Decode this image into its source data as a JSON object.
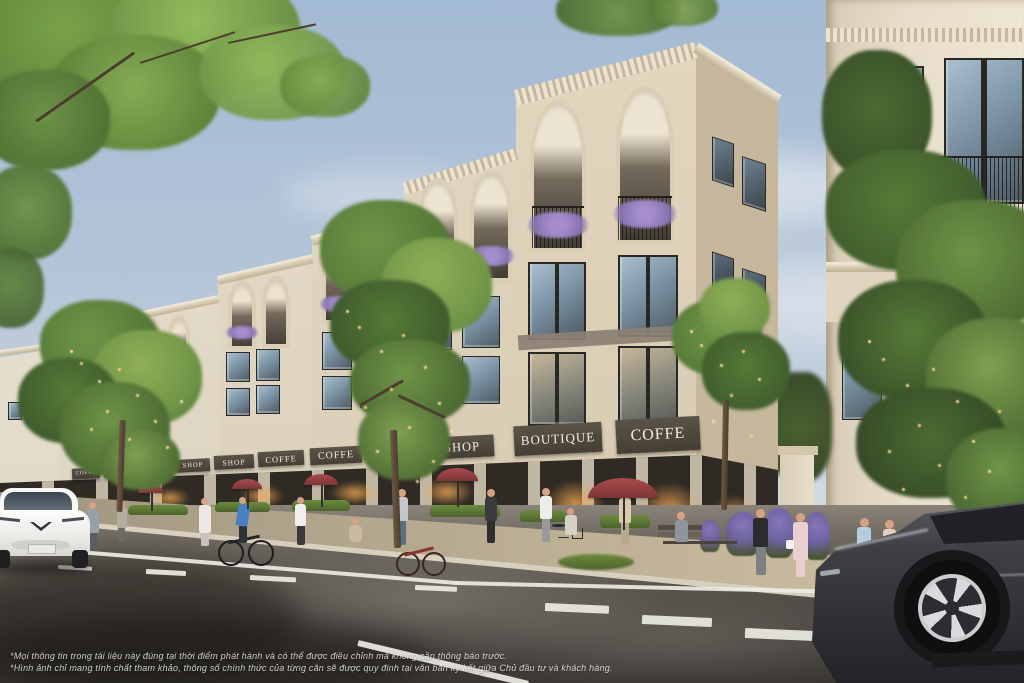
{
  "facade": {
    "signs": [
      {
        "label": "COFFE"
      },
      {
        "label": "BOUTIQUE"
      },
      {
        "label": "COFFE"
      },
      {
        "label": "SHOP"
      },
      {
        "label": "SHOP"
      },
      {
        "label": "COFFE"
      },
      {
        "label": "COFFE"
      },
      {
        "label": "SHOP"
      },
      {
        "label": "SHOP"
      },
      {
        "label": "BOUTIQUE"
      },
      {
        "label": "COFFE"
      }
    ]
  },
  "disclaimer": {
    "line1": "*Mọi thông tin trong tài liệu này đúng tại thời điểm phát hành và có thể được điều chỉnh mà không cần thông báo trước.",
    "line2": "*Hình ảnh chỉ mang tính chất tham khảo, thông số chính thức của từng căn sẽ được quy định tại văn bản ký kết giữa Chủ đầu tư và khách hàng."
  },
  "palette": {
    "sky_top": "#a3bad4",
    "sky_bottom": "#e3e7ea",
    "facade_cream": "#e2d7c1",
    "awning": "#453e34",
    "sign_text": "#f3eee3",
    "umbrella_red": "#a84c4c",
    "wisteria_purple": "#ab92d4",
    "foliage_green": "#567a37",
    "string_lights": "#ffd98a",
    "road_dark": "#3a3733",
    "suv_gray": "#3f4045",
    "car_white": "#f6f7f6"
  }
}
